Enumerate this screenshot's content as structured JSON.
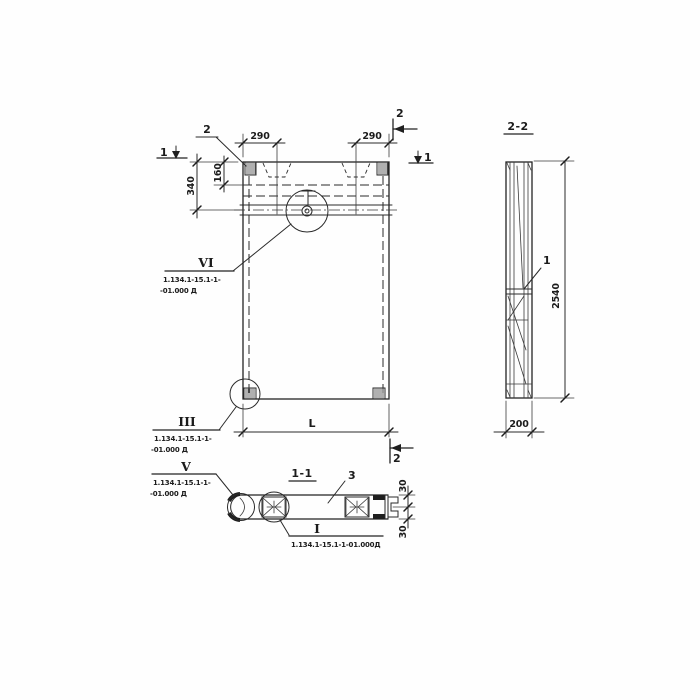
{
  "elevation": {
    "marker_1_left": "1",
    "marker_1_right": "1",
    "marker_2_top": "2",
    "marker_2_bottom": "2",
    "leader_2": "2",
    "dim_290_left": "290",
    "dim_290_right": "290",
    "dim_340": "340",
    "dim_160": "160",
    "dim_L": "L"
  },
  "section22": {
    "title": "2-2",
    "label_1": "1",
    "dim_2540": "2540",
    "dim_200": "200"
  },
  "section11": {
    "title": "1-1",
    "label_3": "3",
    "dim_30_top": "30",
    "dim_30_bottom": "30"
  },
  "callout_VI": {
    "num": "VI",
    "ref1": "1.134.1-15.1-1-",
    "ref2": "-01.000 Д"
  },
  "callout_III": {
    "num": "III",
    "ref1": "1.134.1-15.1-1-",
    "ref2": "-01.000 Д"
  },
  "callout_V": {
    "num": "V",
    "ref1": "1.134.1-15.1-1-",
    "ref2": "-01.000 Д"
  },
  "callout_I": {
    "num": "I",
    "ref": "1.134.1-15.1-1-01.000Д"
  }
}
